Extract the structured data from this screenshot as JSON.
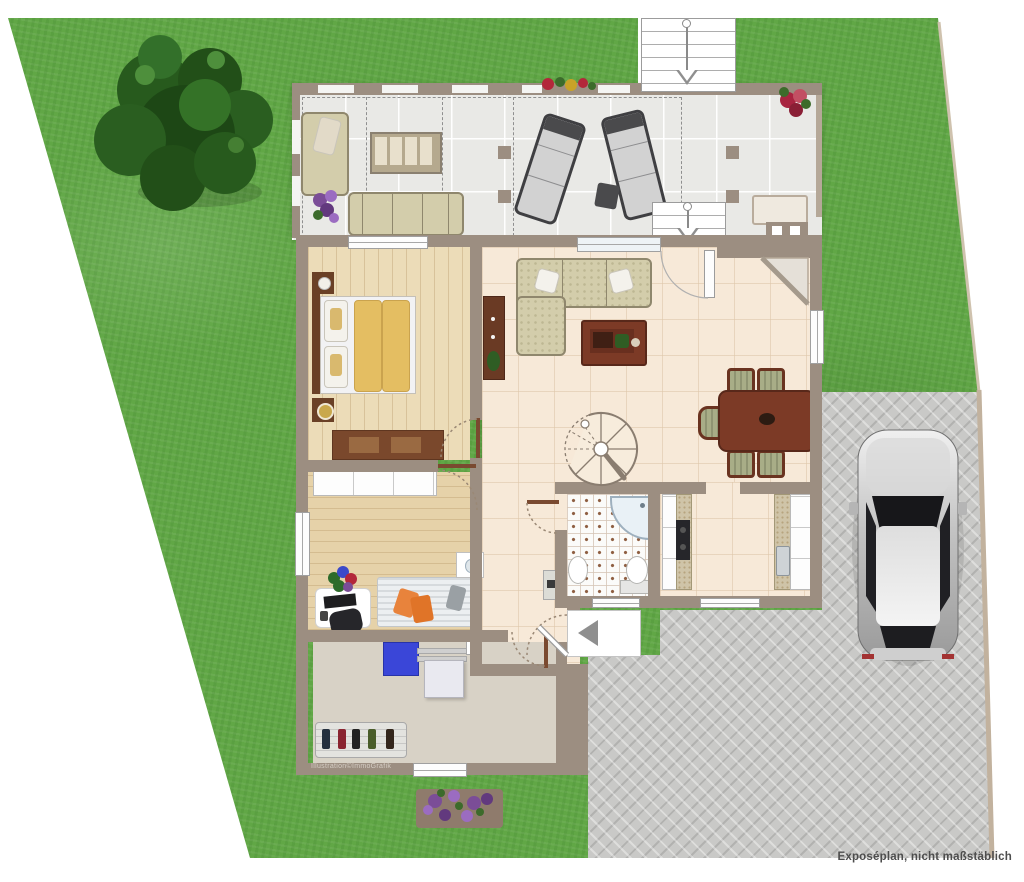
{
  "annotations": {
    "footer_note": "Exposéplan, nicht maßstäblich",
    "watermark": "Illustration©ImmoGrafik"
  },
  "palette": {
    "grass": "#61a746",
    "wall_taupe": "#9c8e81",
    "terrace_tile": "#e9e9e6",
    "interior_tile": "#f7e9d8",
    "bedroom_floor": "#ecdcb8",
    "office_floor": "#e6d2a9",
    "utility_floor": "#d8d2c6",
    "bathroom_tile": "#fbfbf9",
    "driveway_paver": "#c9c9c7",
    "dark_wood": "#7c3a26",
    "sofa_fabric": "#d3cdab",
    "duvet_yellow": "#e4be62",
    "accent_blue": "#3a46d8",
    "accent_orange": "#e8833c",
    "car_silver": "#cccccc",
    "flower_purple": "#7b4d97",
    "flower_red": "#b3273a"
  },
  "legend": {
    "rooms": [
      "terrace",
      "living-room",
      "dining-area",
      "bedroom",
      "kitchen",
      "bathroom",
      "hallway",
      "office",
      "utility-room",
      "entrance"
    ],
    "outdoor_features": [
      "garden-lawn",
      "tree",
      "flower-bed",
      "driveway",
      "parked-car",
      "external-stairs",
      "terrace-stairs",
      "pergola",
      "sun-loungers",
      "outdoor-corner-sofa",
      "outdoor-sofa",
      "outdoor-table",
      "grill"
    ]
  }
}
